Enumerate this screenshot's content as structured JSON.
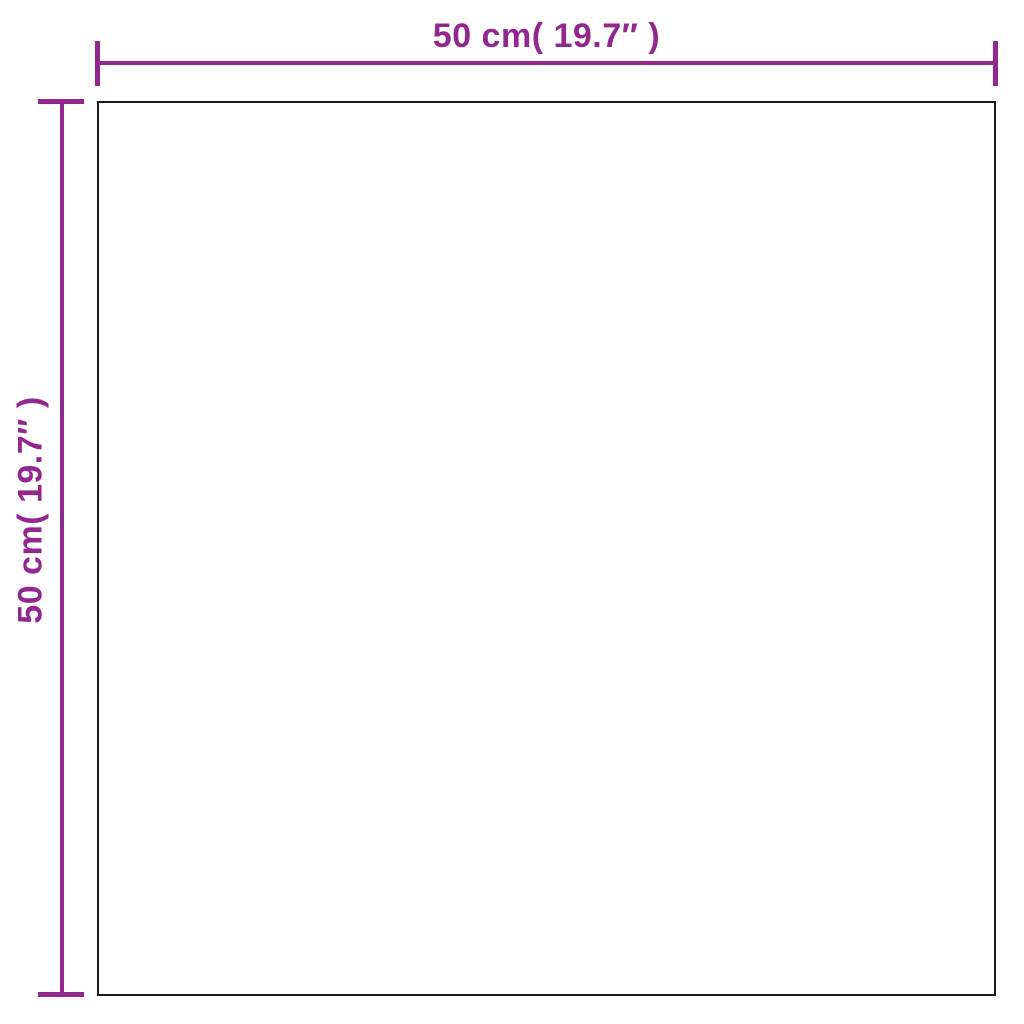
{
  "diagram": {
    "type": "product-dimension-diagram",
    "shape": "square",
    "width_label": "50 cm( 19.7″ )",
    "height_label": "50 cm( 19.7″ )",
    "dimensions": {
      "width_cm": 50,
      "width_inches": 19.7,
      "height_cm": 50,
      "height_inches": 19.7
    },
    "colors": {
      "dimension": "#92278F",
      "outline": "#1A1A1A",
      "background": "#FFFFFF"
    }
  }
}
